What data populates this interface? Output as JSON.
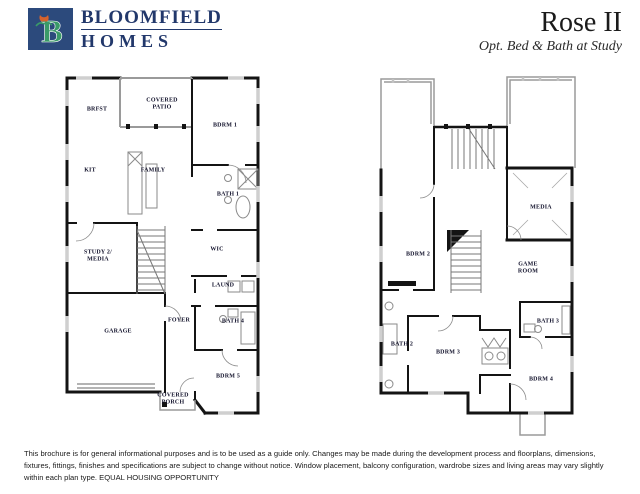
{
  "header": {
    "logo": {
      "line1": "BLOOMFIELD",
      "line2": "HOMES",
      "monogram": "B",
      "square_color": "#2c4a7c",
      "monogram_color": "#3a9a68",
      "tulip_color": "#d4622d",
      "text_color": "#22386b"
    },
    "plan_title": "Rose II",
    "plan_subtitle": "Opt. Bed & Bath at Study"
  },
  "plans": {
    "first_floor": {
      "rooms": [
        {
          "label": "BRFST",
          "x": 65,
          "y": 44
        },
        {
          "label": "COVERED\nPATIO",
          "x": 130,
          "y": 38
        },
        {
          "label": "BDRM 1",
          "x": 193,
          "y": 60
        },
        {
          "label": "KIT",
          "x": 58,
          "y": 105
        },
        {
          "label": "FAMILY",
          "x": 121,
          "y": 105
        },
        {
          "label": "BATH 1",
          "x": 196,
          "y": 129
        },
        {
          "label": "WIC",
          "x": 185,
          "y": 184
        },
        {
          "label": "STUDY 2/\nMEDIA",
          "x": 66,
          "y": 190
        },
        {
          "label": "LAUND",
          "x": 191,
          "y": 220
        },
        {
          "label": "FOYER",
          "x": 147,
          "y": 255
        },
        {
          "label": "BATH 4",
          "x": 201,
          "y": 256
        },
        {
          "label": "GARAGE",
          "x": 86,
          "y": 266
        },
        {
          "label": "BDRM 5",
          "x": 196,
          "y": 311
        },
        {
          "label": "COVERED\nPORCH",
          "x": 141,
          "y": 333
        }
      ]
    },
    "second_floor": {
      "rooms": [
        {
          "label": "MEDIA",
          "x": 173,
          "y": 142
        },
        {
          "label": "BDRM 2",
          "x": 50,
          "y": 189
        },
        {
          "label": "GAME\nROOM",
          "x": 160,
          "y": 202
        },
        {
          "label": "BATH 3",
          "x": 180,
          "y": 256
        },
        {
          "label": "BATH 2",
          "x": 34,
          "y": 279
        },
        {
          "label": "BDRM 3",
          "x": 80,
          "y": 287
        },
        {
          "label": "BDRM 4",
          "x": 173,
          "y": 314
        }
      ]
    }
  },
  "footer": {
    "disclaimer": "This brochure is for general informational purposes and is to be used as a guide only. Changes may be made during the development process and floorplans, dimensions, fixtures, fittings, finishes and specifications are subject to change without notice. Window placement, balcony configuration, wardrobe sizes and living areas may vary slightly within each plan type.  EQUAL HOUSING OPPORTUNITY"
  },
  "colors": {
    "wall_dark": "#141414",
    "wall_light": "#9a9a9a",
    "label_text": "#10102a"
  }
}
